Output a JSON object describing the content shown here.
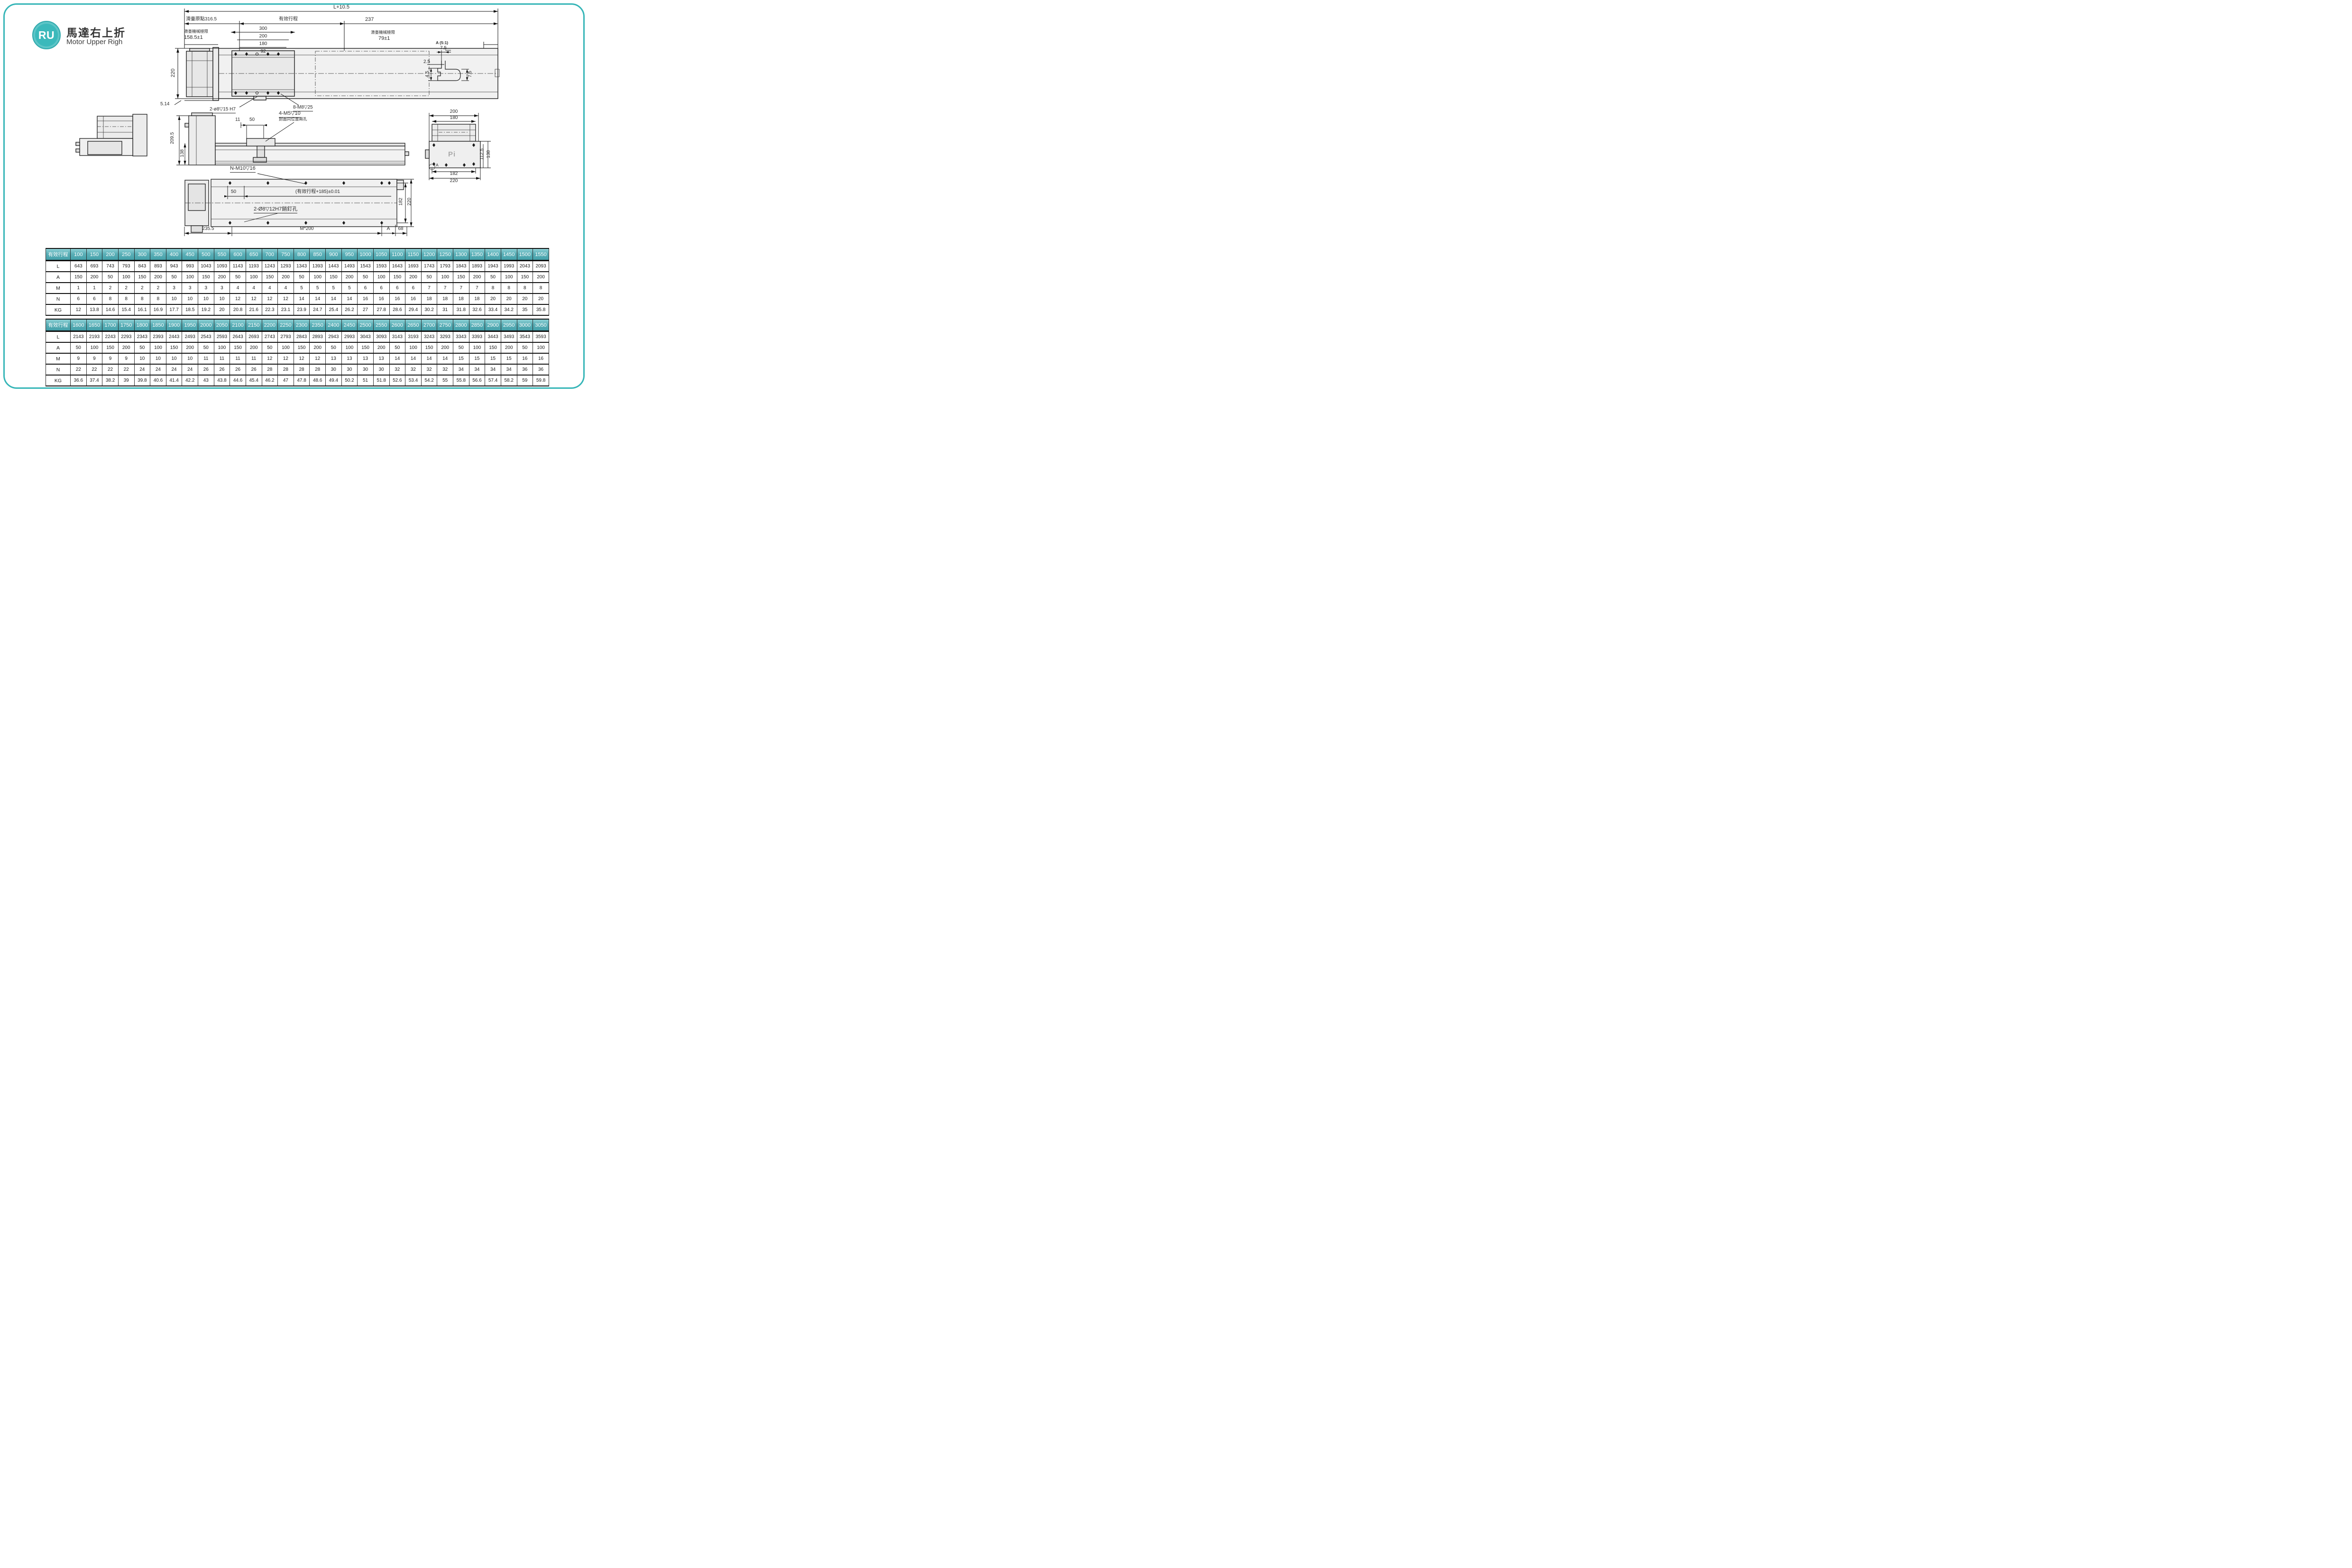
{
  "header": {
    "badge": "RU",
    "title": "馬達右上折",
    "subtitle": "Motor Upper Righ",
    "accent_color": "#35b5b7"
  },
  "drawings": {
    "top_view": {
      "total_length": "L+10.5",
      "origin": "滑臺原點316.5",
      "stroke_label": "有效行程",
      "right_offset": "237",
      "d300": "300",
      "d200": "200",
      "d180": "180",
      "d92": "92",
      "limit_label_left": "滑臺機械極限",
      "limit_value_left": "158.5±1",
      "limit_label_right": "滑臺機械極限",
      "limit_value_right": "79±1",
      "height": "220",
      "base_height": "5.14",
      "pin_hole_note": "2-ø8▽15 H7",
      "screw_note": "8-M8▽25"
    },
    "detail_a": {
      "title": "A (5:1)",
      "w": "7.5",
      "t": "2.5",
      "h1": "4.5",
      "h2": "7.5"
    },
    "side_view": {
      "total_height": "209.5",
      "rail_height": "138",
      "d11": "11",
      "d50": "50",
      "screw_note": "4-M5▽10",
      "screw_note2": "封面同位置兩孔"
    },
    "end_view": {
      "w200": "200",
      "w180": "180",
      "h112": "112.5",
      "h138": "138",
      "w182": "182",
      "w220": "220",
      "logo": "Pi",
      "detail_ref": "A"
    },
    "bottom_view": {
      "screw_note": "N-M10▽16",
      "d50": "50",
      "stroke_note": "(有效行程+185)±0.01",
      "pin_note": "2-Ø8▽12H7銷釘孔",
      "d235": "235.5",
      "pitch": "M*200",
      "ref_a": "A",
      "d68": "68",
      "h182": "182",
      "h220": "220"
    }
  },
  "tables": [
    {
      "corner": "有效行程",
      "strokes": [
        100,
        150,
        200,
        250,
        300,
        350,
        400,
        450,
        500,
        550,
        600,
        650,
        700,
        750,
        800,
        850,
        900,
        950,
        1000,
        1050,
        1100,
        1150,
        1200,
        1250,
        1300,
        1350,
        1400,
        1450,
        1500,
        1550
      ],
      "rows": [
        {
          "label": "L",
          "values": [
            643,
            693,
            743,
            793,
            843,
            893,
            943,
            993,
            1043,
            1093,
            1143,
            1193,
            1243,
            1293,
            1343,
            1393,
            1443,
            1493,
            1543,
            1593,
            1643,
            1693,
            1743,
            1793,
            1843,
            1893,
            1943,
            1993,
            2043,
            2093
          ]
        },
        {
          "label": "A",
          "values": [
            150,
            200,
            50,
            100,
            150,
            200,
            50,
            100,
            150,
            200,
            50,
            100,
            150,
            200,
            50,
            100,
            150,
            200,
            50,
            100,
            150,
            200,
            50,
            100,
            150,
            200,
            50,
            100,
            150,
            200
          ]
        },
        {
          "label": "M",
          "values": [
            1,
            1,
            2,
            2,
            2,
            2,
            3,
            3,
            3,
            3,
            4,
            4,
            4,
            4,
            5,
            5,
            5,
            5,
            6,
            6,
            6,
            6,
            7,
            7,
            7,
            7,
            8,
            8,
            8,
            8
          ]
        },
        {
          "label": "N",
          "values": [
            6,
            6,
            8,
            8,
            8,
            8,
            10,
            10,
            10,
            10,
            12,
            12,
            12,
            12,
            14,
            14,
            14,
            14,
            16,
            16,
            16,
            16,
            18,
            18,
            18,
            18,
            20,
            20,
            20,
            20
          ]
        },
        {
          "label": "KG",
          "values": [
            12,
            13.8,
            14.6,
            15.4,
            16.1,
            16.9,
            17.7,
            18.5,
            19.2,
            20,
            20.8,
            21.6,
            22.3,
            23.1,
            23.9,
            24.7,
            25.4,
            26.2,
            27,
            27.8,
            28.6,
            29.4,
            30.2,
            31,
            31.8,
            32.6,
            33.4,
            34.2,
            35,
            35.8
          ]
        }
      ]
    },
    {
      "corner": "有效行程",
      "strokes": [
        1600,
        1650,
        1700,
        1750,
        1800,
        1850,
        1900,
        1950,
        2000,
        2050,
        2100,
        2150,
        2200,
        2250,
        2300,
        2350,
        2400,
        2450,
        2500,
        2550,
        2600,
        2650,
        2700,
        2750,
        2800,
        2850,
        2900,
        2950,
        3000,
        3050
      ],
      "rows": [
        {
          "label": "L",
          "values": [
            2143,
            2193,
            2243,
            2293,
            2343,
            2393,
            2443,
            2493,
            2543,
            2593,
            2643,
            2693,
            2743,
            2793,
            2843,
            2893,
            2943,
            2993,
            3043,
            3093,
            3143,
            3193,
            3243,
            3293,
            3343,
            3393,
            3443,
            3493,
            3543,
            3593
          ]
        },
        {
          "label": "A",
          "values": [
            50,
            100,
            150,
            200,
            50,
            100,
            150,
            200,
            50,
            100,
            150,
            200,
            50,
            100,
            150,
            200,
            50,
            100,
            150,
            200,
            50,
            100,
            150,
            200,
            50,
            100,
            150,
            200,
            50,
            100
          ]
        },
        {
          "label": "M",
          "values": [
            9,
            9,
            9,
            9,
            10,
            10,
            10,
            10,
            11,
            11,
            11,
            11,
            12,
            12,
            12,
            12,
            13,
            13,
            13,
            13,
            14,
            14,
            14,
            14,
            15,
            15,
            15,
            15,
            16,
            16
          ]
        },
        {
          "label": "N",
          "values": [
            22,
            22,
            22,
            22,
            24,
            24,
            24,
            24,
            26,
            26,
            26,
            26,
            28,
            28,
            28,
            28,
            30,
            30,
            30,
            30,
            32,
            32,
            32,
            32,
            34,
            34,
            34,
            34,
            36,
            36
          ]
        },
        {
          "label": "KG",
          "values": [
            36.6,
            37.4,
            38.2,
            39,
            39.8,
            40.6,
            41.4,
            42.2,
            43,
            43.8,
            44.6,
            45.4,
            46.2,
            47,
            47.8,
            48.6,
            49.4,
            50.2,
            51,
            51.8,
            52.6,
            53.4,
            54.2,
            55,
            55.8,
            56.6,
            57.4,
            58.2,
            59,
            59.8
          ]
        }
      ]
    }
  ]
}
